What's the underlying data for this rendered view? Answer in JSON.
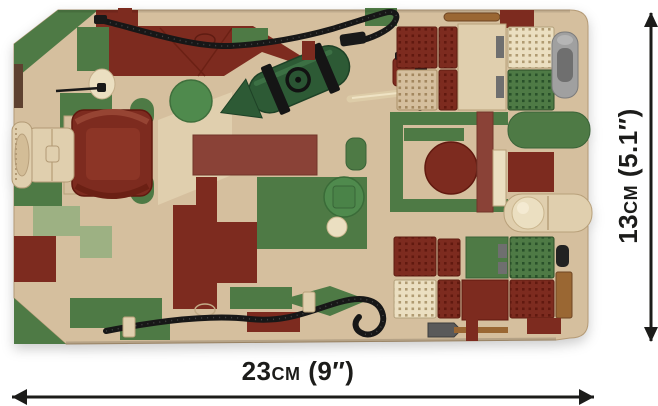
{
  "figure": {
    "width_label": "23cm (9″)",
    "height_label": "13cm (5.1″)"
  },
  "colors": {
    "bg": "#ffffff",
    "ink": "#1c1c1a",
    "tan": "#d5bf9e",
    "tan_light": "#e0cfae",
    "cream": "#ebdfc1",
    "green": "#4e7a45",
    "green_bright": "#4f8a4d",
    "green_dark": "#2d5a35",
    "sage": "#9db183",
    "maroon": "#7d2b1f",
    "maroon_dark": "#61190f",
    "red_brown": "#8a4237",
    "wood": "#9a6733",
    "brown_dark": "#5e4130",
    "gray": "#a0a0a0",
    "gray_dark": "#6f6f6f",
    "black": "#191919",
    "knob": "#efe7d2"
  }
}
